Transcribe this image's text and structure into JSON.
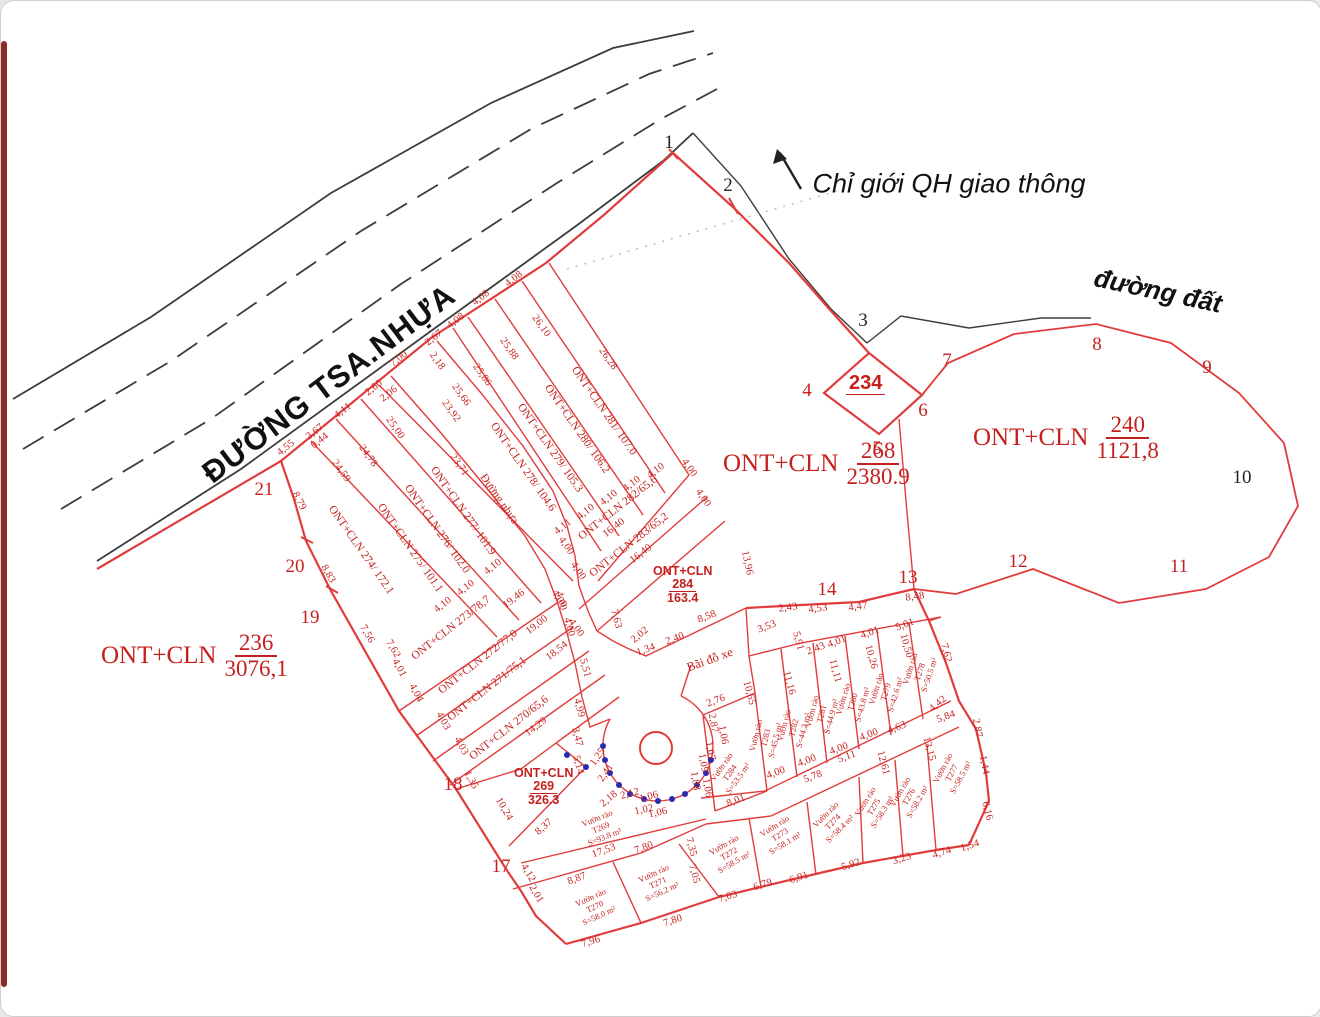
{
  "colors": {
    "red_line": "#e23b3b",
    "red_text": "#c5201d",
    "black_line": "#3c3c3c",
    "blue_dot": "#2a2ab0"
  },
  "labels": {
    "main_road": "ĐƯỜNG TSA.NHỰA",
    "planning_boundary": "Chỉ giới QH giao thông",
    "dirt_road": "đường đất",
    "parking_lot": "Bãi đỗ xe"
  },
  "parcel_fractions": [
    {
      "id": "236",
      "pre": "ONT+CLN",
      "num": "236",
      "den": "3076,1",
      "x": 100,
      "y": 630,
      "kind": "lg"
    },
    {
      "id": "268",
      "pre": "ONT+CLN",
      "num": "268",
      "den": "2380.9",
      "x": 722,
      "y": 438,
      "kind": "lg"
    },
    {
      "id": "240",
      "pre": "ONT+CLN",
      "num": "240",
      "den": "1121,8",
      "x": 972,
      "y": 412,
      "kind": "lg"
    },
    {
      "id": "284",
      "pre": "ONT+CLN",
      "num": "284",
      "den": "163.4",
      "x": 652,
      "y": 563,
      "kind": "sm"
    },
    {
      "id": "269",
      "pre": "ONT+CLN",
      "num": "269",
      "den": "326.3",
      "x": 513,
      "y": 765,
      "kind": "sm"
    },
    {
      "id": "234",
      "pre": "",
      "num": "234",
      "den": "",
      "x": 845,
      "y": 372,
      "kind": "dm"
    }
  ],
  "boundary_points": [
    {
      "n": "1",
      "x": 668,
      "y": 142,
      "c": "black"
    },
    {
      "n": "2",
      "x": 727,
      "y": 185,
      "c": "black"
    },
    {
      "n": "3",
      "x": 862,
      "y": 320,
      "c": "black"
    },
    {
      "n": "4",
      "x": 806,
      "y": 390,
      "c": "red"
    },
    {
      "n": "5",
      "x": 876,
      "y": 448,
      "c": "red"
    },
    {
      "n": "6",
      "x": 922,
      "y": 410,
      "c": "red"
    },
    {
      "n": "7",
      "x": 946,
      "y": 360,
      "c": "red"
    },
    {
      "n": "8",
      "x": 1096,
      "y": 344,
      "c": "red"
    },
    {
      "n": "9",
      "x": 1206,
      "y": 367,
      "c": "red"
    },
    {
      "n": "10",
      "x": 1241,
      "y": 477,
      "c": "black"
    },
    {
      "n": "11",
      "x": 1178,
      "y": 566,
      "c": "red"
    },
    {
      "n": "12",
      "x": 1017,
      "y": 561,
      "c": "red"
    },
    {
      "n": "13",
      "x": 907,
      "y": 577,
      "c": "red"
    },
    {
      "n": "14",
      "x": 826,
      "y": 589,
      "c": "red"
    },
    {
      "n": "17",
      "x": 500,
      "y": 866,
      "c": "red"
    },
    {
      "n": "18",
      "x": 452,
      "y": 784,
      "c": "red"
    },
    {
      "n": "19",
      "x": 309,
      "y": 617,
      "c": "red"
    },
    {
      "n": "20",
      "x": 294,
      "y": 566,
      "c": "red"
    },
    {
      "n": "21",
      "x": 263,
      "y": 489,
      "c": "red"
    }
  ],
  "strip_labels": [
    {
      "t": "ONT+CLN 281/ 107.0",
      "x": 603,
      "y": 410,
      "r": 55
    },
    {
      "t": "ONT+CLN 280/ 106.2",
      "x": 576,
      "y": 428,
      "r": 55
    },
    {
      "t": "ONT+CLN 279/ 105.3",
      "x": 549,
      "y": 447,
      "r": 55
    },
    {
      "t": "ONT+CLN 278/ 104.6",
      "x": 522,
      "y": 466,
      "r": 55
    },
    {
      "t": "Đường nhựa",
      "x": 498,
      "y": 498,
      "r": 55
    },
    {
      "t": "ONT+CLN 277/ 101.9",
      "x": 462,
      "y": 510,
      "r": 55
    },
    {
      "t": "ONT+CLN 276/ 102.0",
      "x": 436,
      "y": 528,
      "r": 55
    },
    {
      "t": "ONT+CLN 275/ 101.1",
      "x": 409,
      "y": 547,
      "r": 55
    },
    {
      "t": "ONT+CLN 274/ 172.1",
      "x": 360,
      "y": 549,
      "r": 55
    },
    {
      "t": "ONT+CLN 282/65,6",
      "x": 617,
      "y": 507,
      "r": -38
    },
    {
      "t": "ONT+CLN 283/65,2",
      "x": 628,
      "y": 544,
      "r": -38
    },
    {
      "t": "ONT+CLN 273/78,7",
      "x": 450,
      "y": 627,
      "r": -38
    },
    {
      "t": "ONT+CLN 272/77,0",
      "x": 477,
      "y": 661,
      "r": -38
    },
    {
      "t": "ONT+CLN 271/75,1",
      "x": 486,
      "y": 688,
      "r": -38
    },
    {
      "t": "ONT+CLN 270/65,6",
      "x": 508,
      "y": 727,
      "r": -38
    }
  ],
  "garden_plots": [
    {
      "name": "Vườn rào",
      "id": "T269",
      "area": "S=93.8 m²",
      "x": 600,
      "y": 827,
      "r": -22
    },
    {
      "name": "Vườn rào",
      "id": "T270",
      "area": "S=58.0 m²",
      "x": 594,
      "y": 906,
      "r": -25
    },
    {
      "name": "Vườn rào",
      "id": "T271",
      "area": "S=56.2 m²",
      "x": 657,
      "y": 882,
      "r": -25
    },
    {
      "name": "Vườn rào",
      "id": "T272",
      "area": "S=58.5 m²",
      "x": 728,
      "y": 853,
      "r": -30
    },
    {
      "name": "Vườn rào",
      "id": "T273",
      "area": "S=58.1 m²",
      "x": 779,
      "y": 834,
      "r": -32
    },
    {
      "name": "Vườn rào",
      "id": "T274",
      "area": "S=58.4 m²",
      "x": 832,
      "y": 821,
      "r": -45
    },
    {
      "name": "Vườn rào",
      "id": "T275",
      "area": "S=58.3 m²",
      "x": 873,
      "y": 806,
      "r": -58
    },
    {
      "name": "Vườn rào",
      "id": "T276",
      "area": "S=58.2 m²",
      "x": 908,
      "y": 796,
      "r": -60
    },
    {
      "name": "Vườn rào",
      "id": "T277",
      "area": "S=58.5 m²",
      "x": 951,
      "y": 772,
      "r": -62
    },
    {
      "name": "Vườn rào",
      "id": "T278",
      "area": "S=50.5 m²",
      "x": 919,
      "y": 671,
      "r": -72
    },
    {
      "name": "Vườn rào",
      "id": "T279",
      "area": "S=42.6 m²",
      "x": 885,
      "y": 691,
      "r": -73
    },
    {
      "name": "Vườn rào",
      "id": "T280",
      "area": "S=43.8 m²",
      "x": 852,
      "y": 701,
      "r": -74
    },
    {
      "name": "Vườn rào",
      "id": "T281",
      "area": "S=44.9 m²",
      "x": 821,
      "y": 713,
      "r": -75
    },
    {
      "name": "Vườn rào",
      "id": "T282",
      "area": "S=44.2 m²",
      "x": 793,
      "y": 727,
      "r": -75
    },
    {
      "name": "Vườn rào",
      "id": "T283",
      "area": "S=45.5 m²",
      "x": 765,
      "y": 737,
      "r": -76
    },
    {
      "name": "Vườn rào",
      "id": "T284",
      "area": "S=53.5 m²",
      "x": 729,
      "y": 772,
      "r": -55
    }
  ],
  "dims": [
    {
      "t": "4,55",
      "x": 285,
      "y": 447,
      "r": -38
    },
    {
      "t": "3,67",
      "x": 314,
      "y": 431,
      "r": -38
    },
    {
      "t": "4,11",
      "x": 342,
      "y": 410,
      "r": -38
    },
    {
      "t": "2,60",
      "x": 373,
      "y": 387,
      "r": -38
    },
    {
      "t": "0,44",
      "x": 319,
      "y": 440,
      "r": -38
    },
    {
      "t": "2,06",
      "x": 388,
      "y": 393,
      "r": -38
    },
    {
      "t": "7,00",
      "x": 398,
      "y": 358,
      "r": -38
    },
    {
      "t": "2,67",
      "x": 433,
      "y": 337,
      "r": -38
    },
    {
      "t": "4,08",
      "x": 455,
      "y": 320,
      "r": -38
    },
    {
      "t": "4,08",
      "x": 480,
      "y": 297,
      "r": -38
    },
    {
      "t": "4,08",
      "x": 513,
      "y": 278,
      "r": -38
    },
    {
      "t": "2,18",
      "x": 436,
      "y": 360,
      "r": 55
    },
    {
      "t": "26,28",
      "x": 607,
      "y": 358,
      "r": 55
    },
    {
      "t": "26,10",
      "x": 540,
      "y": 325,
      "r": 55
    },
    {
      "t": "25,88",
      "x": 508,
      "y": 348,
      "r": 55
    },
    {
      "t": "25,86",
      "x": 481,
      "y": 374,
      "r": 55
    },
    {
      "t": "25,66",
      "x": 460,
      "y": 394,
      "r": 55
    },
    {
      "t": "23,92",
      "x": 450,
      "y": 410,
      "r": 55
    },
    {
      "t": "23,71",
      "x": 458,
      "y": 464,
      "r": 55
    },
    {
      "t": "25,00",
      "x": 394,
      "y": 427,
      "r": 55
    },
    {
      "t": "24,78",
      "x": 367,
      "y": 455,
      "r": 55
    },
    {
      "t": "24,59",
      "x": 340,
      "y": 470,
      "r": 55
    },
    {
      "t": "8,79",
      "x": 298,
      "y": 500,
      "r": 62
    },
    {
      "t": "8,83",
      "x": 327,
      "y": 573,
      "r": 60
    },
    {
      "t": "7,56",
      "x": 366,
      "y": 633,
      "r": 60
    },
    {
      "t": "7,62",
      "x": 392,
      "y": 648,
      "r": 60
    },
    {
      "t": "4,10",
      "x": 655,
      "y": 470,
      "r": -38
    },
    {
      "t": "4,10",
      "x": 631,
      "y": 483,
      "r": -38
    },
    {
      "t": "4,10",
      "x": 608,
      "y": 497,
      "r": -38
    },
    {
      "t": "4,10",
      "x": 585,
      "y": 511,
      "r": -38
    },
    {
      "t": "4,11",
      "x": 562,
      "y": 526,
      "r": -38
    },
    {
      "t": "4,00",
      "x": 688,
      "y": 467,
      "r": 55
    },
    {
      "t": "4,00",
      "x": 702,
      "y": 497,
      "r": 55
    },
    {
      "t": "16,40",
      "x": 613,
      "y": 527,
      "r": -38
    },
    {
      "t": "16,40",
      "x": 640,
      "y": 553,
      "r": -38
    },
    {
      "t": "4,00",
      "x": 565,
      "y": 545,
      "r": 55
    },
    {
      "t": "4,00",
      "x": 577,
      "y": 570,
      "r": 55
    },
    {
      "t": "4,00",
      "x": 558,
      "y": 598,
      "r": 55
    },
    {
      "t": "4,00",
      "x": 575,
      "y": 627,
      "r": 55
    },
    {
      "t": "7,63",
      "x": 615,
      "y": 618,
      "r": 75
    },
    {
      "t": "4,10",
      "x": 442,
      "y": 604,
      "r": -38
    },
    {
      "t": "4,10",
      "x": 465,
      "y": 587,
      "r": -38
    },
    {
      "t": "4,10",
      "x": 492,
      "y": 566,
      "r": -38
    },
    {
      "t": "19,46",
      "x": 513,
      "y": 598,
      "r": -38
    },
    {
      "t": "19,00",
      "x": 536,
      "y": 624,
      "r": -38
    },
    {
      "t": "18,54",
      "x": 556,
      "y": 650,
      "r": -38
    },
    {
      "t": "14,29",
      "x": 535,
      "y": 726,
      "r": -38
    },
    {
      "t": "4,01",
      "x": 398,
      "y": 667,
      "r": 62
    },
    {
      "t": "4,04",
      "x": 415,
      "y": 692,
      "r": 62
    },
    {
      "t": "4,03",
      "x": 442,
      "y": 720,
      "r": 62
    },
    {
      "t": "4,03",
      "x": 460,
      "y": 745,
      "r": 62
    },
    {
      "t": "1,35",
      "x": 470,
      "y": 779,
      "r": 62
    },
    {
      "t": "4,00",
      "x": 560,
      "y": 600,
      "r": 75
    },
    {
      "t": "4,00",
      "x": 568,
      "y": 626,
      "r": 75
    },
    {
      "t": "5,51",
      "x": 584,
      "y": 667,
      "r": 75
    },
    {
      "t": "4,99",
      "x": 578,
      "y": 707,
      "r": 75
    },
    {
      "t": "3,47",
      "x": 576,
      "y": 736,
      "r": 75
    },
    {
      "t": "13,96",
      "x": 746,
      "y": 562,
      "r": 78
    },
    {
      "t": "3,53",
      "x": 766,
      "y": 626,
      "r": -20
    },
    {
      "t": "8,58",
      "x": 706,
      "y": 616,
      "r": -20
    },
    {
      "t": "2,02",
      "x": 639,
      "y": 634,
      "r": -40
    },
    {
      "t": "2,40",
      "x": 674,
      "y": 638,
      "r": -20
    },
    {
      "t": "1,34",
      "x": 645,
      "y": 649,
      "r": -20
    },
    {
      "t": "2,43",
      "x": 787,
      "y": 607,
      "r": -8
    },
    {
      "t": "4,53",
      "x": 817,
      "y": 608,
      "r": -8
    },
    {
      "t": "4,47",
      "x": 857,
      "y": 606,
      "r": -8
    },
    {
      "t": "8,48",
      "x": 914,
      "y": 596,
      "r": -8
    },
    {
      "t": "2,43",
      "x": 815,
      "y": 648,
      "r": -20
    },
    {
      "t": "4,01",
      "x": 836,
      "y": 641,
      "r": -20
    },
    {
      "t": "4,01",
      "x": 869,
      "y": 632,
      "r": -20
    },
    {
      "t": "5,01",
      "x": 904,
      "y": 624,
      "r": -20
    },
    {
      "t": "5,91",
      "x": 797,
      "y": 640,
      "r": 75
    },
    {
      "t": "2,76",
      "x": 715,
      "y": 700,
      "r": -20
    },
    {
      "t": "10,65",
      "x": 748,
      "y": 692,
      "r": 75
    },
    {
      "t": "11,16",
      "x": 788,
      "y": 682,
      "r": 75
    },
    {
      "t": "11,11",
      "x": 834,
      "y": 670,
      "r": 75
    },
    {
      "t": "10,26",
      "x": 870,
      "y": 656,
      "r": 75
    },
    {
      "t": "10,50",
      "x": 905,
      "y": 645,
      "r": 75
    },
    {
      "t": "7,62",
      "x": 945,
      "y": 652,
      "r": 75
    },
    {
      "t": "4,42",
      "x": 937,
      "y": 703,
      "r": -40
    },
    {
      "t": "4,00",
      "x": 775,
      "y": 772,
      "r": -20
    },
    {
      "t": "4,00",
      "x": 806,
      "y": 760,
      "r": -20
    },
    {
      "t": "4,00",
      "x": 838,
      "y": 748,
      "r": -20
    },
    {
      "t": "4,00",
      "x": 868,
      "y": 734,
      "r": -20
    },
    {
      "t": "4,63",
      "x": 896,
      "y": 727,
      "r": -20
    },
    {
      "t": "5,84",
      "x": 945,
      "y": 716,
      "r": -20
    },
    {
      "t": "5,11",
      "x": 846,
      "y": 756,
      "r": -20
    },
    {
      "t": "5,78",
      "x": 812,
      "y": 776,
      "r": -20
    },
    {
      "t": "12,61",
      "x": 882,
      "y": 762,
      "r": 75
    },
    {
      "t": "13,15",
      "x": 928,
      "y": 748,
      "r": 75
    },
    {
      "t": "6,16",
      "x": 986,
      "y": 810,
      "r": 75
    },
    {
      "t": "1,44",
      "x": 983,
      "y": 764,
      "r": 80
    },
    {
      "t": "2,87",
      "x": 976,
      "y": 727,
      "r": 80
    },
    {
      "t": "7,96",
      "x": 590,
      "y": 941,
      "r": -18
    },
    {
      "t": "7,80",
      "x": 672,
      "y": 920,
      "r": -18
    },
    {
      "t": "7,03",
      "x": 727,
      "y": 896,
      "r": -18
    },
    {
      "t": "6,79",
      "x": 762,
      "y": 884,
      "r": -18
    },
    {
      "t": "6,91",
      "x": 798,
      "y": 877,
      "r": -18
    },
    {
      "t": "5,92",
      "x": 850,
      "y": 864,
      "r": -18
    },
    {
      "t": "3,23",
      "x": 901,
      "y": 858,
      "r": -18
    },
    {
      "t": "4,74",
      "x": 941,
      "y": 852,
      "r": -18
    },
    {
      "t": "1,54",
      "x": 969,
      "y": 845,
      "r": -18
    },
    {
      "t": "17,53",
      "x": 603,
      "y": 850,
      "r": -20
    },
    {
      "t": "8,87",
      "x": 576,
      "y": 878,
      "r": -20
    },
    {
      "t": "7,80",
      "x": 643,
      "y": 847,
      "r": -20
    },
    {
      "t": "7,05",
      "x": 693,
      "y": 873,
      "r": 75
    },
    {
      "t": "7,35",
      "x": 690,
      "y": 846,
      "r": 75
    },
    {
      "t": "10,24",
      "x": 503,
      "y": 808,
      "r": 60
    },
    {
      "t": "8,37",
      "x": 543,
      "y": 826,
      "r": -42
    },
    {
      "t": "5,14",
      "x": 577,
      "y": 764,
      "r": 75
    },
    {
      "t": "4,12",
      "x": 527,
      "y": 872,
      "r": 60
    },
    {
      "t": "2,01",
      "x": 535,
      "y": 893,
      "r": 60
    },
    {
      "t": "2,41",
      "x": 605,
      "y": 772,
      "r": -55
    },
    {
      "t": "1,25",
      "x": 597,
      "y": 756,
      "r": -55
    },
    {
      "t": "2,18",
      "x": 608,
      "y": 798,
      "r": -40
    },
    {
      "t": "2,12",
      "x": 629,
      "y": 793,
      "r": -15
    },
    {
      "t": "1,06",
      "x": 648,
      "y": 796,
      "r": -15
    },
    {
      "t": "1,02",
      "x": 643,
      "y": 809,
      "r": -12
    },
    {
      "t": "1,06",
      "x": 657,
      "y": 812,
      "r": -12
    },
    {
      "t": "2,87",
      "x": 712,
      "y": 722,
      "r": 80
    },
    {
      "t": "1,06",
      "x": 722,
      "y": 734,
      "r": 80
    },
    {
      "t": "1,07",
      "x": 709,
      "y": 750,
      "r": 80
    },
    {
      "t": "1,09",
      "x": 702,
      "y": 762,
      "r": 80
    },
    {
      "t": "1,88",
      "x": 694,
      "y": 780,
      "r": 80
    },
    {
      "t": "1,06",
      "x": 706,
      "y": 787,
      "r": 80
    },
    {
      "t": "8,01",
      "x": 735,
      "y": 800,
      "r": -20
    }
  ]
}
